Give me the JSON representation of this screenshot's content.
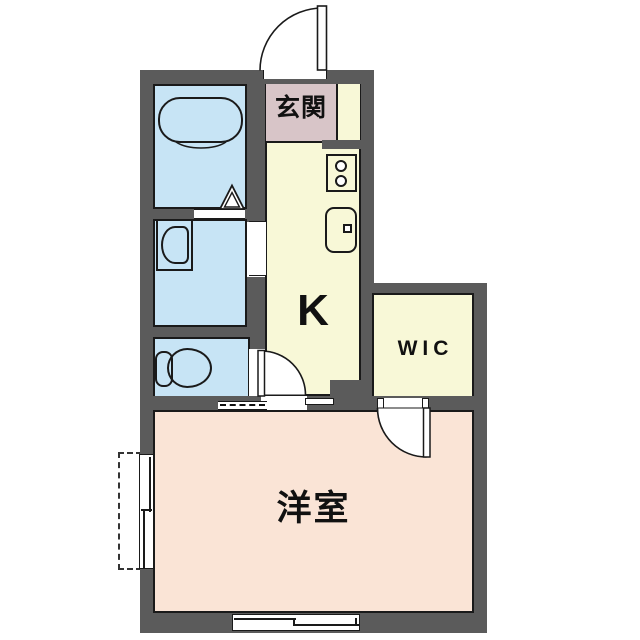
{
  "floorplan": {
    "type": "japanese-apartment-1K-floor-plan",
    "rooms": {
      "genkan": {
        "label": "玄関",
        "fill": "#d8c5c8"
      },
      "kitchen": {
        "label": "K",
        "fill": "#f8f8d7"
      },
      "wic": {
        "label": "WIC",
        "fill": "#f8f8d7"
      },
      "western_room": {
        "label": "洋室",
        "fill": "#fae4d6"
      },
      "bathroom": {
        "fill": "#c7e4f5"
      },
      "washroom": {
        "fill": "#c7e4f5"
      },
      "toilet_room": {
        "fill": "#c7e4f5"
      }
    },
    "colors": {
      "wall": "#5b5b5b",
      "line": "#1a1a1a",
      "background": "#ffffff"
    },
    "fixtures": [
      "entrance-swing-door",
      "bathtub",
      "bathroom-folding-door",
      "wash-basin",
      "toilet",
      "gas-stove-2-burner",
      "kitchen-sink",
      "kitchen-swing-door",
      "wic-swing-door",
      "sliding-window-left",
      "sliding-window-bottom",
      "vent-strip"
    ]
  }
}
